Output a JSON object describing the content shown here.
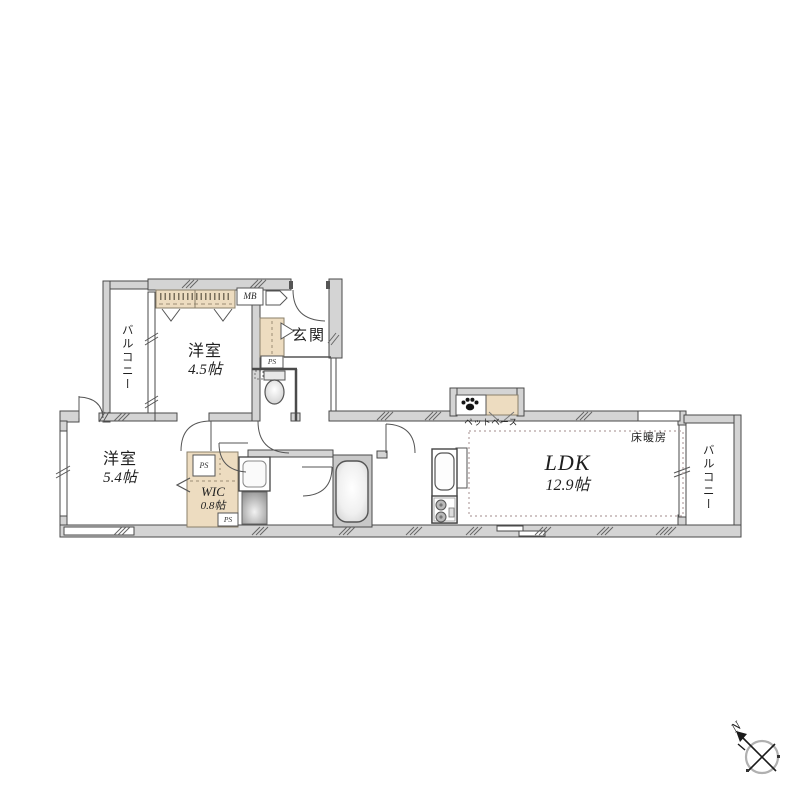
{
  "floorplan": {
    "rooms": {
      "bedroom1": {
        "name": "洋室",
        "size": "4.5帖"
      },
      "bedroom2": {
        "name": "洋室",
        "size": "5.4帖"
      },
      "ldk": {
        "name": "LDK",
        "size": "12.9帖"
      },
      "wic": {
        "name": "WIC",
        "size": "0.8帖"
      },
      "entrance": {
        "name": "玄関"
      },
      "balcony": {
        "name": "バルコニー"
      }
    },
    "labels": {
      "meter_box": "MB",
      "pipe_space": "PS",
      "floor_heating": "床暖房",
      "pet_base": "ペットベース",
      "compass_north": "N"
    },
    "colors": {
      "wall": "#d4d4d4",
      "wall_outline": "#4a4a4a",
      "storage_tan": "#eddcc0",
      "bathroom_gray": "#c8c8c8"
    }
  }
}
